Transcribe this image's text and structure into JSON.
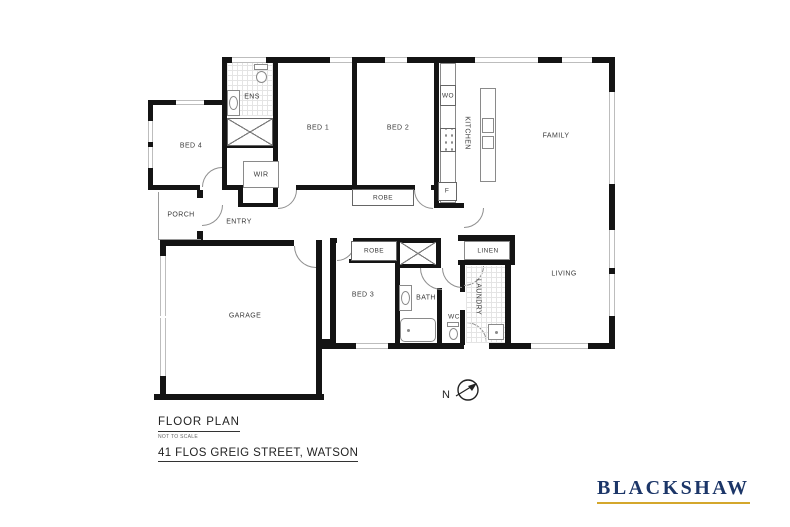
{
  "plan": {
    "rooms": {
      "ens": "ENS",
      "bed4": "BED 4",
      "bed1": "BED 1",
      "bed2": "BED 2",
      "wir": "WIR",
      "robe_bed12": "ROBE",
      "kitchen": "KITCHEN",
      "family": "FAMILY",
      "porch": "PORCH",
      "entry": "ENTRY",
      "garage": "GARAGE",
      "robe_bed3": "ROBE",
      "bed3": "BED 3",
      "bath": "BATH",
      "wc": "WC",
      "laundry": "LAUNDRY",
      "linen": "LINEN",
      "living": "LIVING"
    },
    "appliances": {
      "wall_oven": "WO",
      "fridge": "F"
    },
    "compass": {
      "north": "N"
    }
  },
  "title_block": {
    "title": "FLOOR PLAN",
    "scale_note": "NOT TO SCALE",
    "address": "41 FLOS GREIG STREET, WATSON"
  },
  "branding": {
    "name": "BLACKSHAW"
  },
  "colors": {
    "wall": "#141414",
    "window_frame": "#bdbdbd",
    "door_arc": "#8f8f8f",
    "fixture_outline": "#8a8a8a",
    "label_text": "#3a3a3a",
    "logo_text": "#1c3668",
    "logo_underline": "#d4a72c"
  }
}
